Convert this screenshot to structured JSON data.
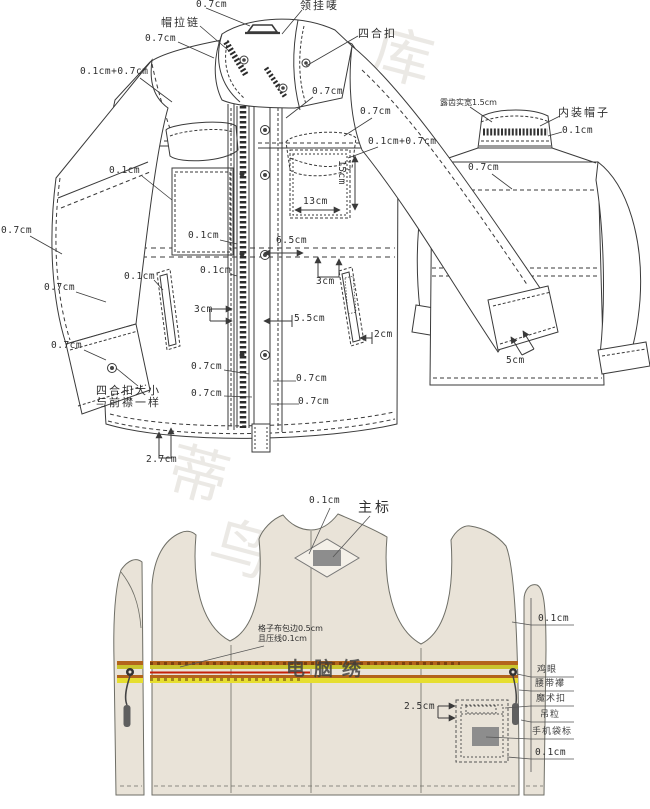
{
  "page": {
    "background": "#ffffff"
  },
  "colors": {
    "line": "#3a3a3a",
    "lining_line": "#6e6e66",
    "fabric_fill": "#e9e3d8",
    "band_brown": "#b3641c",
    "band_olive": "#c9c42e",
    "band_yellow": "#e6de30",
    "band_red": "#c42108",
    "label_gray": "#8d8d8d",
    "watermark_gray": "#d9d4cd"
  },
  "watermark": {
    "items": [
      {
        "text": "库",
        "x": 372,
        "y": 28
      },
      {
        "text": "蒂",
        "x": 168,
        "y": 446
      },
      {
        "text": "鸟",
        "x": 210,
        "y": 520
      },
      {
        "text": "图",
        "x": 282,
        "y": 726
      },
      {
        "text": "库",
        "x": 455,
        "y": 726
      }
    ]
  },
  "front_view": {
    "name": "jacket front technical view",
    "labels": [
      {
        "text": "0.7cm",
        "x": 196,
        "y": 0
      },
      {
        "text": "帽拉链",
        "x": 161,
        "y": 17,
        "cls": "cn"
      },
      {
        "text": "领挂唛",
        "x": 300,
        "y": 0,
        "cls": "cn"
      },
      {
        "text": "四合扣",
        "x": 358,
        "y": 28,
        "cls": "cn"
      },
      {
        "text": "0.7cm",
        "x": 145,
        "y": 34
      },
      {
        "text": "0.1cm+0.7cm",
        "x": 80,
        "y": 67
      },
      {
        "text": "0.7cm",
        "x": 312,
        "y": 87
      },
      {
        "text": "0.7cm",
        "x": 360,
        "y": 107
      },
      {
        "text": "0.1cm+0.7cm",
        "x": 368,
        "y": 137
      },
      {
        "text": "15cm",
        "x": 346,
        "y": 160,
        "cls": "vert"
      },
      {
        "text": "13cm",
        "x": 303,
        "y": 197
      },
      {
        "text": "0.1cm",
        "x": 109,
        "y": 166
      },
      {
        "text": "0.1cm",
        "x": 188,
        "y": 231
      },
      {
        "text": "6.5cm",
        "x": 276,
        "y": 236
      },
      {
        "text": "3cm",
        "x": 316,
        "y": 277
      },
      {
        "text": "0.1cm",
        "x": 200,
        "y": 266
      },
      {
        "text": "0.1cm",
        "x": 124,
        "y": 272
      },
      {
        "text": "3cm",
        "x": 194,
        "y": 305
      },
      {
        "text": "5.5cm",
        "x": 294,
        "y": 314
      },
      {
        "text": "2cm",
        "x": 374,
        "y": 330
      },
      {
        "text": "0.7cm",
        "x": 191,
        "y": 362
      },
      {
        "text": "0.7cm",
        "x": 296,
        "y": 374
      },
      {
        "text": "0.7cm",
        "x": 191,
        "y": 389
      },
      {
        "text": "0.7cm",
        "x": 298,
        "y": 397
      },
      {
        "text": "2.7cm",
        "x": 146,
        "y": 455
      },
      {
        "text": "0.7cm",
        "x": 1,
        "y": 226
      },
      {
        "text": "0.7cm",
        "x": 44,
        "y": 283
      },
      {
        "text": "0.7cm",
        "x": 51,
        "y": 341
      },
      {
        "text": "四合扣大小",
        "x": 96,
        "y": 385,
        "cls": "cn"
      },
      {
        "text": "与前襟一样",
        "x": 96,
        "y": 397,
        "cls": "cn"
      }
    ]
  },
  "back_view": {
    "name": "jacket back technical view",
    "labels": [
      {
        "text": "露齿实宽1.5cm",
        "x": 440,
        "y": 99,
        "cls": "cn-sm"
      },
      {
        "text": "内装帽子",
        "x": 558,
        "y": 107,
        "cls": "cn"
      },
      {
        "text": "0.1cm",
        "x": 562,
        "y": 126
      },
      {
        "text": "0.7cm",
        "x": 468,
        "y": 163
      },
      {
        "text": "5cm",
        "x": 506,
        "y": 356
      }
    ]
  },
  "lining_view": {
    "name": "jacket lining technical view",
    "embroidery_text": "电脑绣",
    "labels": [
      {
        "text": "0.1cm",
        "x": 309,
        "y": 496
      },
      {
        "text": "主标",
        "x": 358,
        "y": 501,
        "cls": "cn-lg"
      },
      {
        "text": "格子布包边0.5cm",
        "x": 258,
        "y": 625,
        "cls": "cn-sm"
      },
      {
        "text": "且压线0.1cm",
        "x": 258,
        "y": 635,
        "cls": "cn-sm"
      },
      {
        "text": "2.5cm",
        "x": 404,
        "y": 702
      },
      {
        "text": "0.1cm",
        "x": 538,
        "y": 614
      },
      {
        "text": "鸡眼",
        "x": 537,
        "y": 666,
        "cls": "cn-s2"
      },
      {
        "text": "腰带襻",
        "x": 535,
        "y": 680,
        "cls": "cn-s2"
      },
      {
        "text": "魔术扣",
        "x": 536,
        "y": 695,
        "cls": "cn-s2"
      },
      {
        "text": "吊粒",
        "x": 540,
        "y": 711,
        "cls": "cn-s2"
      },
      {
        "text": "手机袋标",
        "x": 532,
        "y": 728,
        "cls": "cn-s2"
      },
      {
        "text": "0.1cm",
        "x": 535,
        "y": 748
      }
    ]
  }
}
